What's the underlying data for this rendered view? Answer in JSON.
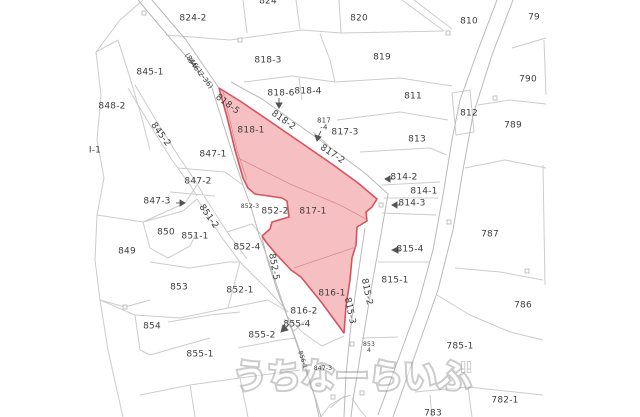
{
  "map": {
    "type": "cadastral-parcel-map",
    "colors": {
      "background": "#ffffff",
      "parcel_line": "#cccccc",
      "road_line": "#b9b9b9",
      "label_text": "#3c3c3c",
      "highlight_fill": "#f6c0c3",
      "highlight_border": "#d5535f",
      "watermark": "#a3a3a3"
    },
    "watermark": {
      "text": "うちなーらいふ",
      "suffix": "!!"
    },
    "labels": [
      {
        "text": "824-2",
        "x": 193,
        "y": 19
      },
      {
        "text": "824",
        "x": 268,
        "y": 2
      },
      {
        "text": "820",
        "x": 359,
        "y": 19
      },
      {
        "text": "810",
        "x": 469,
        "y": 22
      },
      {
        "text": "79",
        "x": 534,
        "y": 18
      },
      {
        "text": "818-3",
        "x": 268,
        "y": 61
      },
      {
        "text": "819",
        "x": 382,
        "y": 58
      },
      {
        "text": "845-1",
        "x": 150,
        "y": 73
      },
      {
        "text": "(846-1",
        "x": 193,
        "y": 64,
        "rot": 52,
        "size": 7
      },
      {
        "text": "846-2-36)",
        "x": 200,
        "y": 74,
        "rot": 52,
        "size": 7
      },
      {
        "text": "848-2",
        "x": 112,
        "y": 107
      },
      {
        "text": "818-6",
        "x": 281,
        "y": 94
      },
      {
        "text": "818-4",
        "x": 308,
        "y": 92
      },
      {
        "text": "790",
        "x": 528,
        "y": 80
      },
      {
        "text": "811",
        "x": 413,
        "y": 97
      },
      {
        "text": "818-5",
        "x": 227,
        "y": 105,
        "rot": 37
      },
      {
        "text": "818-2",
        "x": 283,
        "y": 121,
        "rot": 35
      },
      {
        "text": "817",
        "x": 324,
        "y": 121,
        "size": 7
      },
      {
        "text": "-4",
        "x": 324,
        "y": 128,
        "size": 7
      },
      {
        "text": "817-3",
        "x": 345,
        "y": 133
      },
      {
        "text": "812",
        "x": 469,
        "y": 114
      },
      {
        "text": "813",
        "x": 417,
        "y": 140
      },
      {
        "text": "789",
        "x": 513,
        "y": 126
      },
      {
        "text": "I-1",
        "x": 95,
        "y": 151
      },
      {
        "text": "845-2",
        "x": 160,
        "y": 135,
        "rot": 54
      },
      {
        "text": "818-1",
        "x": 251,
        "y": 131
      },
      {
        "text": "817-2",
        "x": 332,
        "y": 155,
        "rot": 34
      },
      {
        "text": "847-1",
        "x": 213,
        "y": 155
      },
      {
        "text": "847-2",
        "x": 198,
        "y": 182
      },
      {
        "text": "814-2",
        "x": 404,
        "y": 178
      },
      {
        "text": "814-1",
        "x": 424,
        "y": 192
      },
      {
        "text": "814-3",
        "x": 412,
        "y": 204
      },
      {
        "text": "847-3",
        "x": 157,
        "y": 202
      },
      {
        "text": "852-3",
        "x": 250,
        "y": 207,
        "size": 6
      },
      {
        "text": "852-2",
        "x": 275,
        "y": 212
      },
      {
        "text": "817-1",
        "x": 313,
        "y": 212
      },
      {
        "text": "851-2",
        "x": 208,
        "y": 217,
        "rot": 55
      },
      {
        "text": "850",
        "x": 166,
        "y": 233
      },
      {
        "text": "851-1",
        "x": 195,
        "y": 237
      },
      {
        "text": "787",
        "x": 490,
        "y": 235
      },
      {
        "text": "852-4",
        "x": 247,
        "y": 248
      },
      {
        "text": "815-4",
        "x": 410,
        "y": 250
      },
      {
        "text": "849",
        "x": 127,
        "y": 252
      },
      {
        "text": "852-5",
        "x": 273,
        "y": 267,
        "rot": 80
      },
      {
        "text": "815-1",
        "x": 395,
        "y": 281
      },
      {
        "text": "853",
        "x": 179,
        "y": 288
      },
      {
        "text": "852-1",
        "x": 240,
        "y": 291
      },
      {
        "text": "816-1",
        "x": 332,
        "y": 294
      },
      {
        "text": "815-2",
        "x": 366,
        "y": 292,
        "rot": 78
      },
      {
        "text": "815-3",
        "x": 349,
        "y": 311,
        "rot": 78
      },
      {
        "text": "786",
        "x": 523,
        "y": 306
      },
      {
        "text": "816-2",
        "x": 304,
        "y": 312
      },
      {
        "text": "855-4",
        "x": 297,
        "y": 325
      },
      {
        "text": "854",
        "x": 152,
        "y": 327
      },
      {
        "text": "855-2",
        "x": 262,
        "y": 336
      },
      {
        "text": "785-1",
        "x": 460,
        "y": 347
      },
      {
        "text": "853",
        "x": 369,
        "y": 345,
        "size": 6
      },
      {
        "text": "4",
        "x": 369,
        "y": 351,
        "size": 6
      },
      {
        "text": "855-1",
        "x": 200,
        "y": 355
      },
      {
        "text": "856-1",
        "x": 302,
        "y": 360,
        "rot": 72,
        "size": 6
      },
      {
        "text": "847-3",
        "x": 323,
        "y": 369,
        "size": 6
      },
      {
        "text": "782-1",
        "x": 505,
        "y": 401
      },
      {
        "text": "783",
        "x": 433,
        "y": 414
      }
    ]
  }
}
